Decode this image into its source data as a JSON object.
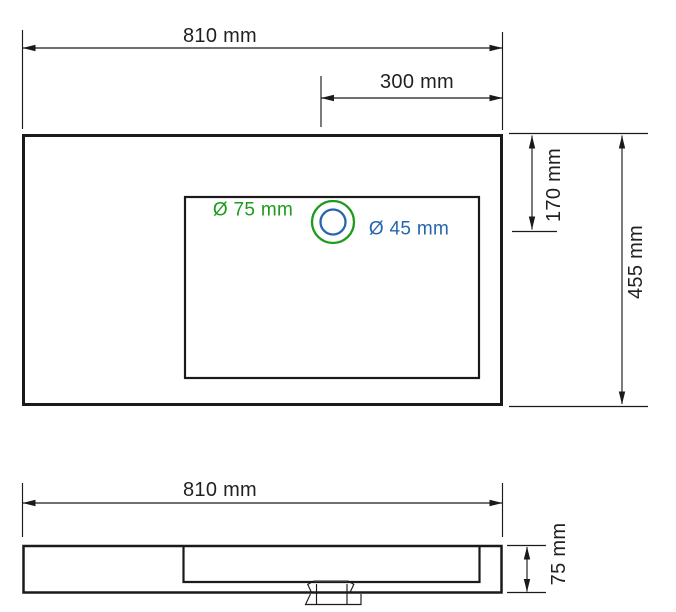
{
  "drawing": {
    "type": "technical-dimension-drawing",
    "subject": "wall-hung washbasin, top view and side view",
    "colors": {
      "line": "#1a1a1a",
      "text": "#231f20",
      "green": "#1d9b1d",
      "blue": "#2765af"
    },
    "top_view": {
      "overall_width_label": "810 mm",
      "tap_hole_offset_label": "300 mm",
      "overall_depth_label": "455 mm",
      "hole_center_offset_label": "170 mm",
      "outer_hole_diameter_label": "Ø 75 mm",
      "inner_hole_diameter_label": "Ø 45 mm"
    },
    "side_view": {
      "overall_width_label": "810 mm",
      "overall_height_label": "75 mm"
    }
  }
}
